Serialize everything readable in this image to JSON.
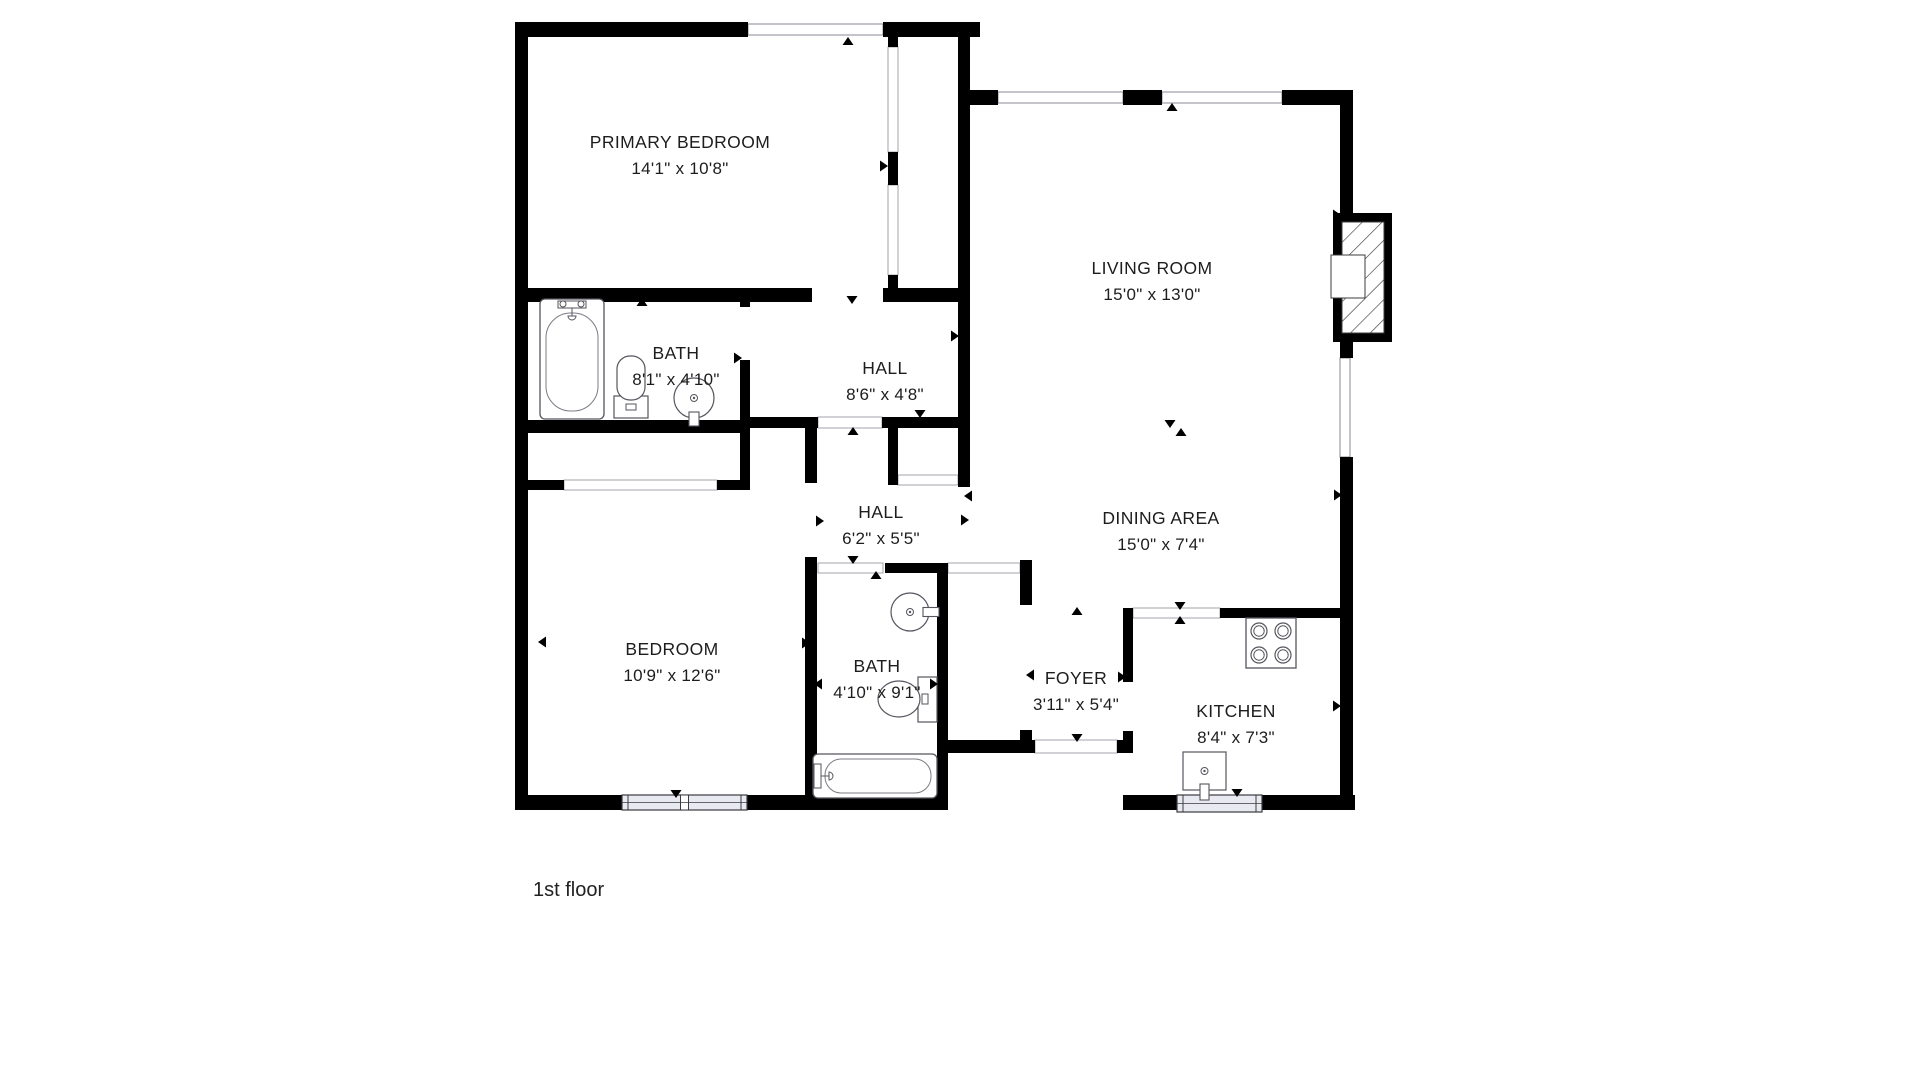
{
  "floor_label": {
    "text": "1st floor",
    "x": 533,
    "y": 896,
    "size": 20
  },
  "palette": {
    "wall": "#000000",
    "window_fill": "#e9e9f2",
    "fixture_line": "#55555e",
    "opening_line": "#9a9aa5",
    "text": "#1d1d1d",
    "background": "#ffffff"
  },
  "rooms": [
    {
      "id": "primary-bedroom",
      "label": "PRIMARY BEDROOM",
      "dims": "14'1\" x 10'8\"",
      "x": 680,
      "y": 142
    },
    {
      "id": "living-room",
      "label": "LIVING ROOM",
      "dims": "15'0\" x 13'0\"",
      "x": 1152,
      "y": 268
    },
    {
      "id": "bath-1",
      "label": "BATH",
      "dims": "8'1\" x 4'10\"",
      "x": 676,
      "y": 353
    },
    {
      "id": "hall-1",
      "label": "HALL",
      "dims": "8'6\" x 4'8\"",
      "x": 885,
      "y": 368
    },
    {
      "id": "hall-2",
      "label": "HALL",
      "dims": "6'2\" x 5'5\"",
      "x": 881,
      "y": 512
    },
    {
      "id": "dining-area",
      "label": "DINING AREA",
      "dims": "15'0\" x 7'4\"",
      "x": 1161,
      "y": 518
    },
    {
      "id": "bedroom",
      "label": "BEDROOM",
      "dims": "10'9\" x 12'6\"",
      "x": 672,
      "y": 649
    },
    {
      "id": "bath-2",
      "label": "BATH",
      "dims": "4'10\" x 9'1\"",
      "x": 877,
      "y": 666
    },
    {
      "id": "foyer",
      "label": "FOYER",
      "dims": "3'11\" x 5'4\"",
      "x": 1076,
      "y": 678
    },
    {
      "id": "kitchen",
      "label": "KITCHEN",
      "dims": "8'4\" x 7'3\"",
      "x": 1236,
      "y": 711
    }
  ],
  "walls": [
    [
      515,
      22,
      233,
      15
    ],
    [
      883,
      22,
      97,
      15
    ],
    [
      515,
      22,
      13,
      788
    ],
    [
      515,
      795,
      433,
      15
    ],
    [
      1123,
      795,
      232,
      15
    ],
    [
      958,
      37,
      12,
      450
    ],
    [
      970,
      90,
      28,
      15
    ],
    [
      1123,
      90,
      39,
      15
    ],
    [
      1282,
      90,
      71,
      15
    ],
    [
      1340,
      105,
      13,
      108
    ],
    [
      1340,
      342,
      13,
      16
    ],
    [
      1340,
      457,
      13,
      353
    ],
    [
      515,
      288,
      297,
      14
    ],
    [
      883,
      288,
      87,
      14
    ],
    [
      888,
      37,
      10,
      10
    ],
    [
      888,
      152,
      10,
      33
    ],
    [
      888,
      275,
      10,
      27
    ],
    [
      740,
      288,
      10,
      19
    ],
    [
      740,
      360,
      10,
      70
    ],
    [
      515,
      420,
      235,
      13
    ],
    [
      740,
      420,
      10,
      70
    ],
    [
      515,
      480,
      49,
      10
    ],
    [
      717,
      480,
      33,
      10
    ],
    [
      740,
      417,
      78,
      11
    ],
    [
      882,
      417,
      76,
      11
    ],
    [
      805,
      417,
      12,
      66
    ],
    [
      805,
      557,
      12,
      240
    ],
    [
      888,
      417,
      10,
      58
    ],
    [
      888,
      475,
      10,
      10
    ],
    [
      958,
      475,
      12,
      12
    ],
    [
      885,
      563,
      52,
      10
    ],
    [
      937,
      563,
      11,
      244
    ],
    [
      948,
      740,
      87,
      13
    ],
    [
      1117,
      740,
      16,
      13
    ],
    [
      1020,
      560,
      12,
      45
    ],
    [
      1020,
      730,
      12,
      23
    ],
    [
      1123,
      608,
      10,
      74
    ],
    [
      1123,
      731,
      10,
      22
    ],
    [
      1220,
      608,
      133,
      10
    ]
  ],
  "openings": [
    {
      "x": 748,
      "y": 24,
      "w": 135,
      "h": 11,
      "type": "win"
    },
    {
      "x": 998,
      "y": 92,
      "w": 125,
      "h": 11,
      "type": "win"
    },
    {
      "x": 1162,
      "y": 92,
      "w": 120,
      "h": 11,
      "type": "win"
    },
    {
      "x": 1340,
      "y": 358,
      "w": 10,
      "h": 99,
      "type": "win"
    },
    {
      "x": 888,
      "y": 47,
      "w": 10,
      "h": 105,
      "type": "cased"
    },
    {
      "x": 888,
      "y": 185,
      "w": 10,
      "h": 90,
      "type": "cased"
    },
    {
      "x": 818,
      "y": 417,
      "w": 64,
      "h": 11,
      "type": "cased"
    },
    {
      "x": 898,
      "y": 475,
      "w": 60,
      "h": 10,
      "type": "cased"
    },
    {
      "x": 564,
      "y": 480,
      "w": 153,
      "h": 10,
      "type": "cased"
    },
    {
      "x": 818,
      "y": 563,
      "w": 65,
      "h": 10,
      "type": "cased"
    },
    {
      "x": 948,
      "y": 563,
      "w": 72,
      "h": 10,
      "type": "cased"
    },
    {
      "x": 1133,
      "y": 608,
      "w": 87,
      "h": 10,
      "type": "cased"
    },
    {
      "x": 1035,
      "y": 740,
      "w": 82,
      "h": 13,
      "type": "cased"
    },
    {
      "x": 812,
      "y": 288,
      "w": 71,
      "h": 14,
      "type": "gap"
    },
    {
      "x": 740,
      "y": 307,
      "w": 10,
      "h": 53,
      "type": "gap"
    },
    {
      "x": 805,
      "y": 483,
      "w": 12,
      "h": 74,
      "type": "gap"
    },
    {
      "x": 1020,
      "y": 605,
      "w": 12,
      "h": 125,
      "type": "gap"
    },
    {
      "x": 1123,
      "y": 682,
      "w": 10,
      "h": 49,
      "type": "gap"
    }
  ],
  "bottom_windows": [
    {
      "x": 622,
      "y": 795,
      "w": 125,
      "h": 15,
      "panes": 2
    },
    {
      "x": 1177,
      "y": 795,
      "w": 85,
      "h": 17,
      "panes": 1
    }
  ],
  "fireplace": {
    "x": 1333,
    "y": 213,
    "w": 59,
    "h": 129,
    "hatch": [
      1342,
      222,
      42,
      111
    ],
    "firebox": [
      1331,
      255,
      34,
      43
    ]
  },
  "fixtures": [
    {
      "type": "bathtub",
      "x": 540,
      "y": 299,
      "w": 64,
      "h": 120,
      "orient": "v"
    },
    {
      "type": "toilet",
      "x": 614,
      "y": 356,
      "orient": "up"
    },
    {
      "type": "sink-round",
      "cx": 694,
      "cy": 398,
      "r": 20,
      "stub": "bottom"
    },
    {
      "type": "sink-round",
      "cx": 910,
      "cy": 612,
      "r": 19,
      "stub": "right"
    },
    {
      "type": "toilet",
      "x": 878,
      "y": 677,
      "orient": "right"
    },
    {
      "type": "bathtub",
      "x": 813,
      "y": 754,
      "w": 124,
      "h": 44,
      "orient": "h"
    },
    {
      "type": "stove",
      "x": 1246,
      "y": 618,
      "w": 50,
      "h": 50
    },
    {
      "type": "sink-square",
      "x": 1183,
      "y": 752,
      "w": 43,
      "h": 38
    }
  ],
  "markers": [
    {
      "x": 848,
      "y": 41,
      "dir": "up"
    },
    {
      "x": 1172,
      "y": 107,
      "dir": "up"
    },
    {
      "x": 522,
      "y": 145,
      "dir": "left"
    },
    {
      "x": 1337,
      "y": 215,
      "dir": "right"
    },
    {
      "x": 642,
      "y": 302,
      "dir": "up"
    },
    {
      "x": 852,
      "y": 300,
      "dir": "down"
    },
    {
      "x": 738,
      "y": 358,
      "dir": "right"
    },
    {
      "x": 955,
      "y": 336,
      "dir": "right"
    },
    {
      "x": 920,
      "y": 414,
      "dir": "down"
    },
    {
      "x": 853,
      "y": 431,
      "dir": "up"
    },
    {
      "x": 884,
      "y": 166,
      "dir": "right"
    },
    {
      "x": 1170,
      "y": 424,
      "dir": "down"
    },
    {
      "x": 1181,
      "y": 432,
      "dir": "up"
    },
    {
      "x": 1338,
      "y": 495,
      "dir": "right"
    },
    {
      "x": 820,
      "y": 521,
      "dir": "right"
    },
    {
      "x": 968,
      "y": 496,
      "dir": "left"
    },
    {
      "x": 965,
      "y": 520,
      "dir": "right"
    },
    {
      "x": 542,
      "y": 642,
      "dir": "left"
    },
    {
      "x": 806,
      "y": 643,
      "dir": "right"
    },
    {
      "x": 853,
      "y": 560,
      "dir": "down"
    },
    {
      "x": 876,
      "y": 575,
      "dir": "up"
    },
    {
      "x": 818,
      "y": 684,
      "dir": "left"
    },
    {
      "x": 934,
      "y": 684,
      "dir": "right"
    },
    {
      "x": 1077,
      "y": 611,
      "dir": "up"
    },
    {
      "x": 1077,
      "y": 738,
      "dir": "down"
    },
    {
      "x": 1030,
      "y": 675,
      "dir": "left"
    },
    {
      "x": 1122,
      "y": 677,
      "dir": "right"
    },
    {
      "x": 1180,
      "y": 606,
      "dir": "down"
    },
    {
      "x": 1180,
      "y": 620,
      "dir": "up"
    },
    {
      "x": 1237,
      "y": 793,
      "dir": "down"
    },
    {
      "x": 676,
      "y": 794,
      "dir": "down"
    },
    {
      "x": 1337,
      "y": 706,
      "dir": "right"
    }
  ]
}
